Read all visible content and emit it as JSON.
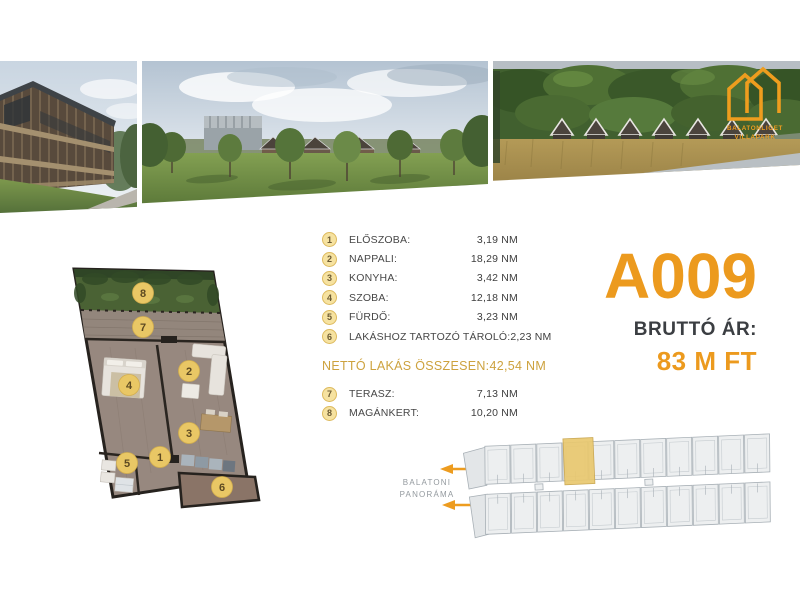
{
  "brand": {
    "name_line1": "BALATONLIGET",
    "name_line2": "VILLAPARK"
  },
  "unit": {
    "code": "A009",
    "price_label": "BRUTTÓ ÁR:",
    "price_value": "83 M FT"
  },
  "rooms": {
    "items": [
      {
        "num": "1",
        "label": "ELŐSZOBA:",
        "value": "3,19 NM"
      },
      {
        "num": "2",
        "label": "NAPPALI:",
        "value": "18,29 NM"
      },
      {
        "num": "3",
        "label": "KONYHA:",
        "value": "3,42 NM"
      },
      {
        "num": "4",
        "label": "SZOBA:",
        "value": "12,18 NM"
      },
      {
        "num": "5",
        "label": "FÜRDŐ:",
        "value": "3,23 NM"
      },
      {
        "num": "6",
        "label": "LAKÁSHOZ TARTOZÓ TÁROLÓ:",
        "value": "2,23 NM"
      }
    ],
    "total": {
      "label": "NETTÓ LAKÁS ÖSSZESEN:",
      "value": "42,54 NM"
    },
    "outdoor": [
      {
        "num": "7",
        "label": "TERASZ:",
        "value": "7,13 NM"
      },
      {
        "num": "8",
        "label": "MAGÁNKERT:",
        "value": "10,20 NM"
      }
    ]
  },
  "floor_plan": {
    "badges": [
      "1",
      "2",
      "3",
      "4",
      "5",
      "6",
      "7",
      "8"
    ]
  },
  "site_plan": {
    "label_line1": "BALATONI",
    "label_line2": "PANORÁMA"
  },
  "colors": {
    "accent": "#EC9A1E",
    "gold_text": "#CDA23E",
    "table_badge_fill": "#F6E2A0",
    "plan_badge_fill": "#E9C765",
    "highlight_unit": "#E9C86F",
    "price_dark": "#3B3E42"
  }
}
